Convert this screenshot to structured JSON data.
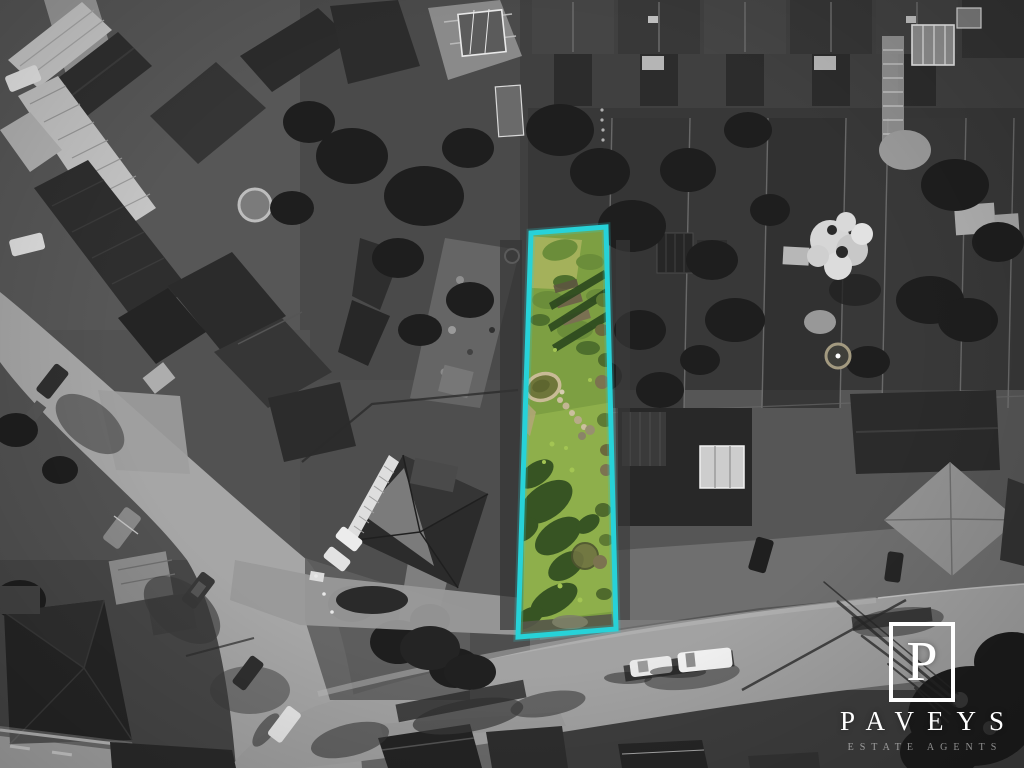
{
  "branding": {
    "monogram": "P",
    "name": "PAVEYS",
    "tagline": "ESTATE AGENTS"
  },
  "colors": {
    "plot_outline": "#27d2d8",
    "grass_base": "#7d9f42",
    "grass_light": "#90b14c",
    "grass_shadow": "#2c481e",
    "grass_dry": "#a9b25e",
    "pond_water": "#6f763a",
    "pond_stone": "#c9bb96",
    "logo_white": "#ffffff"
  }
}
